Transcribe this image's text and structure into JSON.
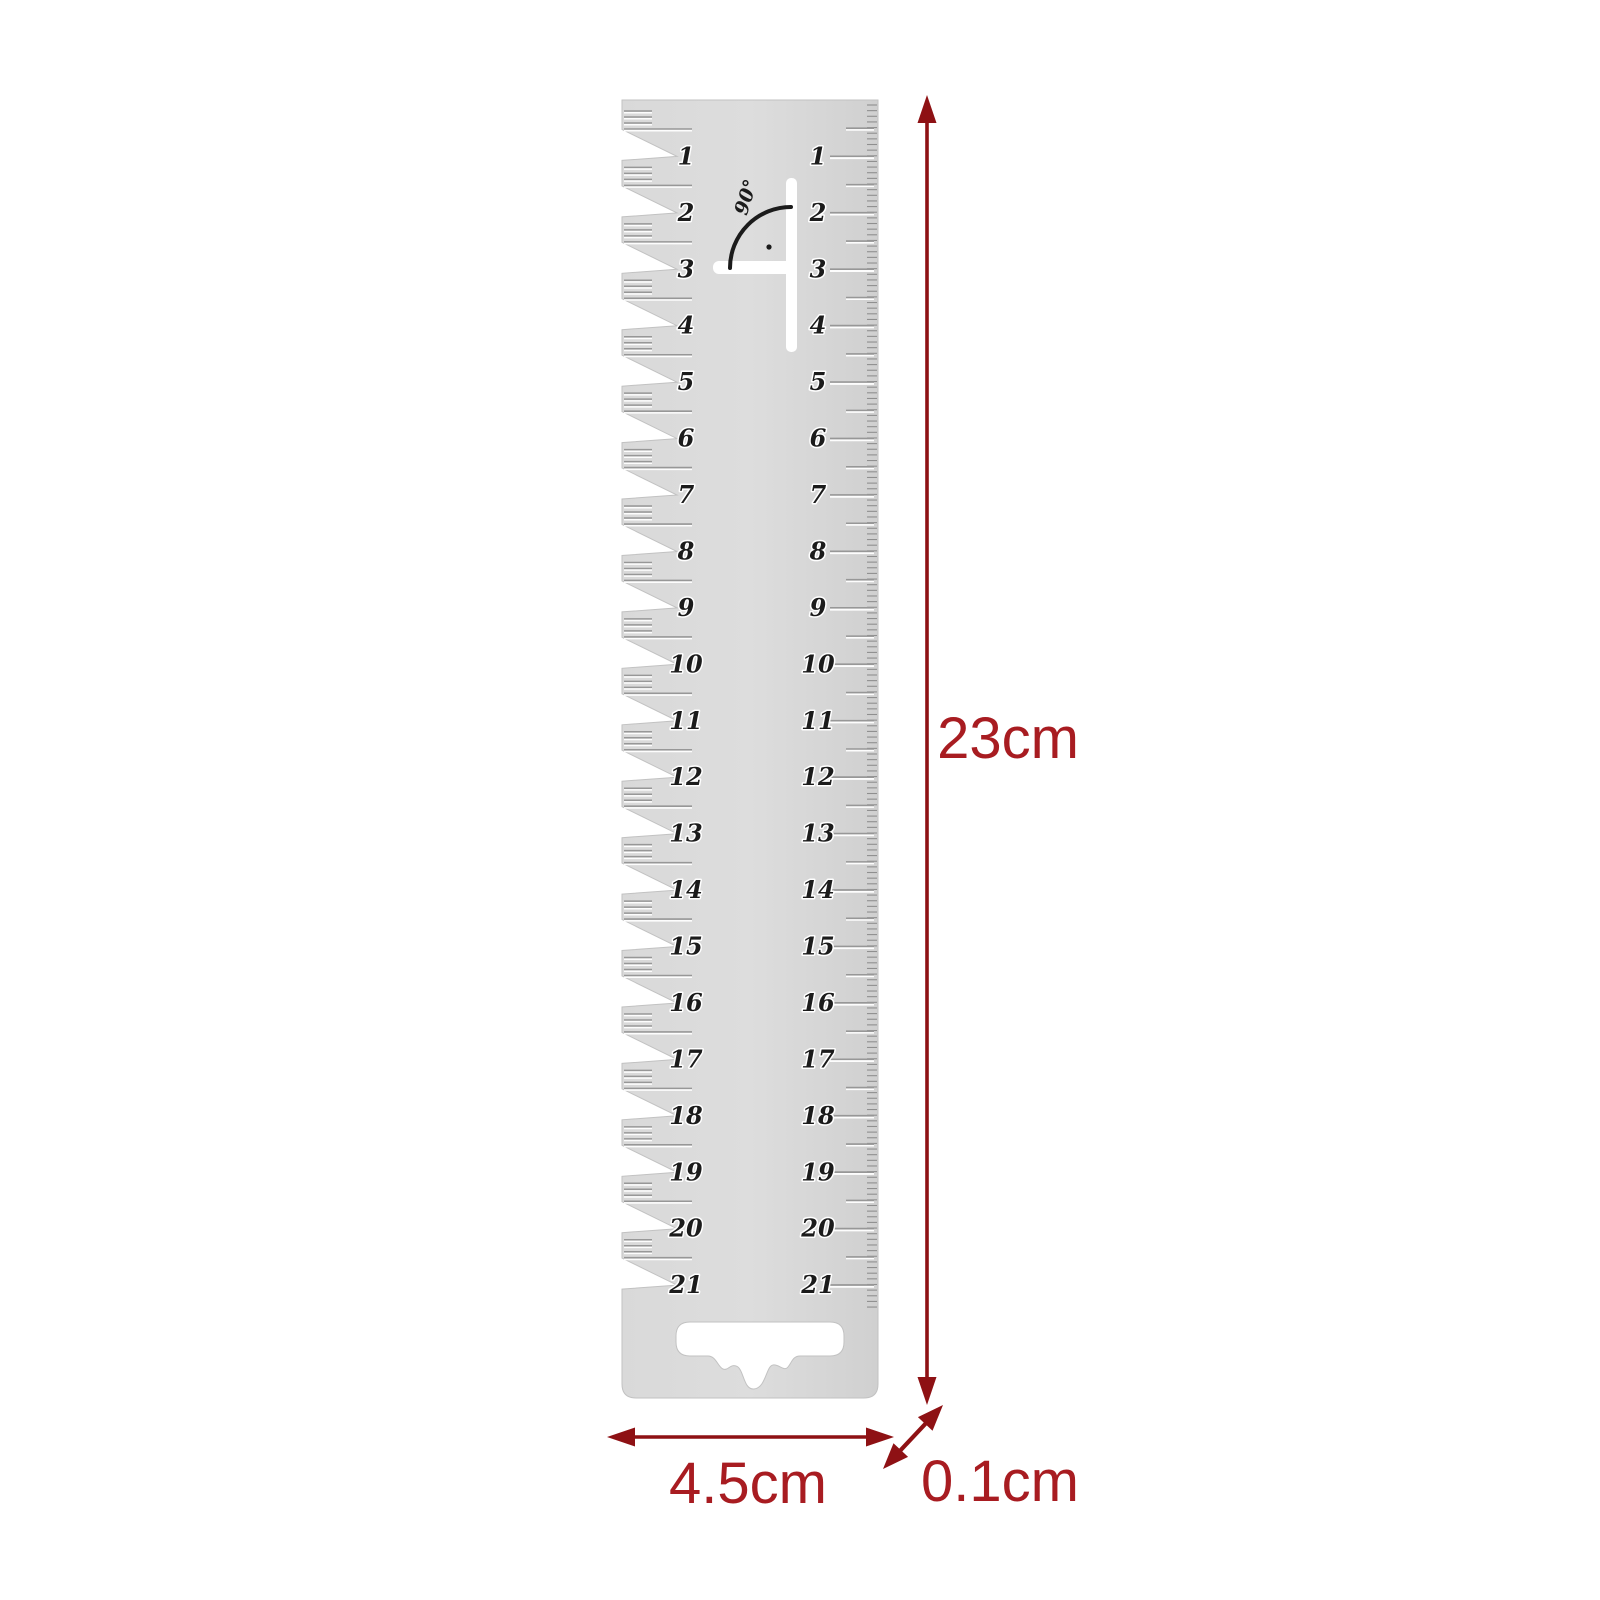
{
  "product": {
    "description": "gauge ruler product photo"
  },
  "ruler": {
    "numbers": [
      "1",
      "2",
      "3",
      "4",
      "5",
      "6",
      "7",
      "8",
      "9",
      "10",
      "11",
      "12",
      "13",
      "14",
      "15",
      "16",
      "17",
      "18",
      "19",
      "20",
      "21"
    ],
    "angle_label": "90°"
  },
  "dimensions": {
    "height": "23cm",
    "width": "4.5cm",
    "thickness": "0.1cm"
  },
  "colors": {
    "annotation_text": "#a81c21",
    "annotation_arrow": "#8e1114",
    "ruler_fill": "#d6d6d6",
    "ruler_fill_light": "#dcdcdc",
    "ruler_edge": "#c2c2c2",
    "tick_dark": "#979797",
    "tick_light": "#fdfdfd",
    "mm_tick": "#8f8f8f",
    "number_ink": "#1b1b1b",
    "background": "#ffffff"
  }
}
